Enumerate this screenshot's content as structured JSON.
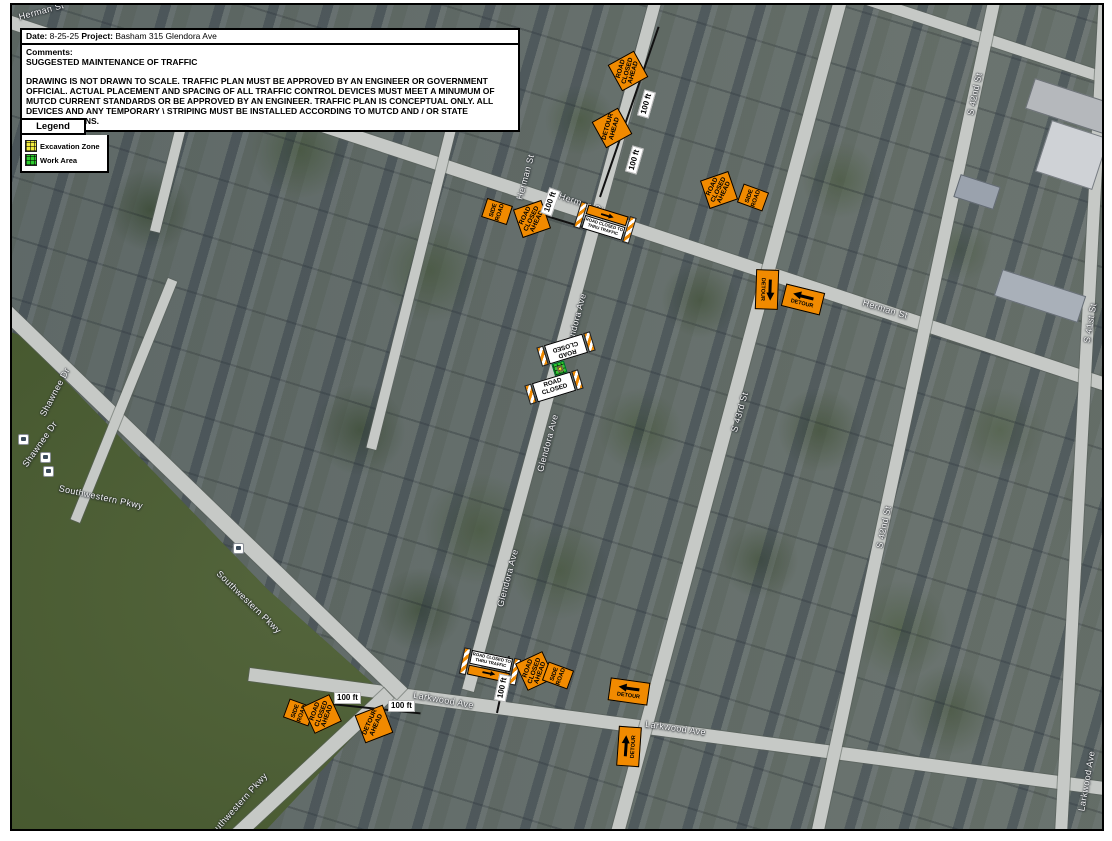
{
  "header": {
    "date_label": "Date:",
    "date_value": "8-25-25",
    "project_label": "Project:",
    "project_value": "Basham 315 Glendora Ave",
    "comments_label": "Comments:",
    "comments_line": "SUGGESTED MAINTENANCE OF TRAFFIC",
    "disclaimer": "DRAWING IS NOT DRAWN TO SCALE. TRAFFIC PLAN MUST BE APPROVED BY AN ENGINEER OR GOVERNMENT OFFICIAL. ACTUAL PLACEMENT AND SPACING OF ALL TRAFFIC CONTROL DEVICES MUST MEET A MINUMUM OF MUTCD CURRENT STANDARDS OR BE APPROVED BY AN ENGINEER. TRAFFIC PLAN IS CONCEPTUAL ONLY. ALL DEVICES AND ANY TEMPORARY \\ STRIPING MUST BE INSTALLED ACCORDING TO MUTCD AND / OR STATE SPECIFICATIONS."
  },
  "legend": {
    "title": "Legend",
    "excavation_zone": "Excavation Zone",
    "work_area": "Work Area"
  },
  "signs": {
    "road_closed_ahead": "ROAD CLOSED AHEAD",
    "detour_ahead": "DETOUR AHEAD",
    "side_road": "SIDE ROAD",
    "detour": "DETOUR",
    "road_closed": "ROAD CLOSED",
    "road_closed_to_thru_traffic": "ROAD CLOSED TO THRU TRAFFIC",
    "distance_100ft": "100 ft"
  },
  "streets": {
    "herman": "Herman St",
    "glendora": "Glendora Ave",
    "s_43rd": "S 43rd St",
    "s_42nd": "S 42nd St",
    "s_41st": "S 41st St",
    "larkwood": "Larkwood Ave",
    "shawnee": "Shawnee Dr",
    "southwestern": "Southwestern Pkwy"
  },
  "colors": {
    "work_sign_orange": "#f18a00",
    "excavation_yellow": "#f2ea3f",
    "work_area_green": "#2ecc2e",
    "barricade_white": "#ffffff"
  }
}
